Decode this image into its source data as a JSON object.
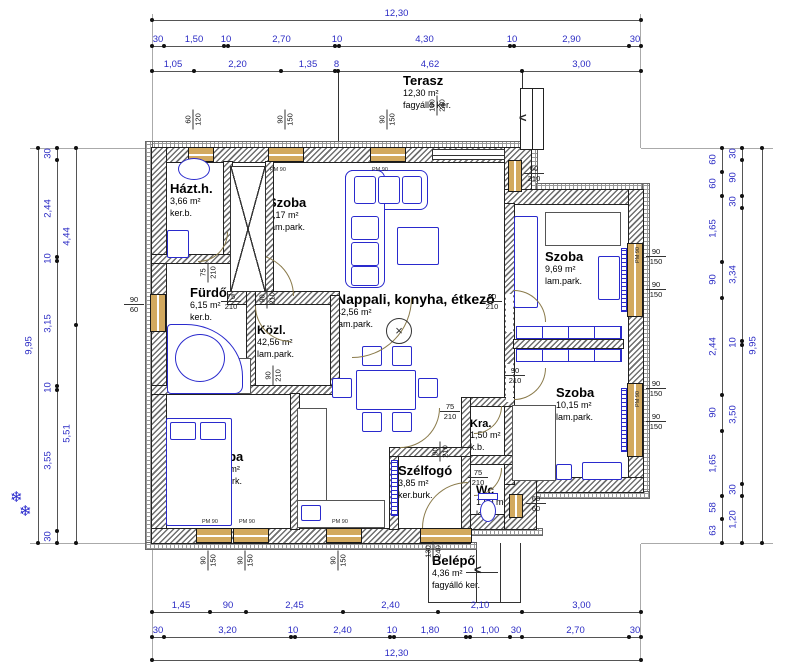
{
  "colors": {
    "dim_text": "#2b2bc4",
    "ink": "#1a1a1a",
    "furniture": "#2a2acd",
    "window_wood": "#d2a95f",
    "door_arc": "#8a7a4a"
  },
  "icons": {
    "stair_arrow": "<",
    "entry_arrow": "<",
    "snowflake": "❄",
    "lamp_cross": "×"
  },
  "rooms": [
    {
      "name": "Terasz",
      "area": "12,30 m²",
      "finish": "fagyálló ker."
    },
    {
      "name": "Házt.h.",
      "area": "3,66 m²",
      "finish": "ker.b."
    },
    {
      "name": "Szoba",
      "area": "8,17 m²",
      "finish": "lam.park."
    },
    {
      "name": "Fürdő",
      "area": "6,15 m²",
      "finish": "ker.b."
    },
    {
      "name": "Közl.",
      "area": "42,56 m²",
      "finish": "lam.park."
    },
    {
      "name": "Nappali, konyha, étkező",
      "area": "42,56 m²",
      "finish": "lam.park."
    },
    {
      "name": "Szoba",
      "area": "11,37 m²",
      "finish": "lam.park."
    },
    {
      "name": "Szoba",
      "area": "9,69 m²",
      "finish": "lam.park."
    },
    {
      "name": "Szoba",
      "area": "10,15 m²",
      "finish": "lam.park."
    },
    {
      "name": "Kra.",
      "area": "1,50 m²",
      "finish": "k.b."
    },
    {
      "name": "Szélfogó",
      "area": "3,85 m²",
      "finish": "ker.burk."
    },
    {
      "name": "Wc",
      "area": "1,60 m²",
      "finish": "k.b."
    },
    {
      "name": "Belépő",
      "area": "4,36 m²",
      "finish": "fagyálló ker."
    }
  ],
  "dim_lines": [
    {
      "o": "h",
      "pos": 20,
      "ticks": [
        152,
        641
      ],
      "labels": [
        "12,30"
      ]
    },
    {
      "o": "h",
      "pos": 46,
      "ticks": [
        152,
        164,
        224,
        228,
        335,
        339,
        510,
        514,
        629,
        641
      ],
      "labels": [
        "30",
        "1,50",
        "10",
        "2,70",
        "10",
        "4,30",
        "10",
        "2,90",
        "30"
      ]
    },
    {
      "o": "h",
      "pos": 71,
      "ticks": [
        152,
        194,
        281,
        335,
        338,
        522,
        641
      ],
      "labels": [
        "1,05",
        "2,20",
        "1,35",
        "8",
        "4,62",
        "3,00"
      ]
    },
    {
      "o": "h",
      "pos": 612,
      "ticks": [
        152,
        210,
        246,
        343,
        438,
        522,
        641
      ],
      "labels": [
        "1,45",
        "90",
        "2,45",
        "2,40",
        "2,10",
        "3,00"
      ]
    },
    {
      "o": "h",
      "pos": 637,
      "ticks": [
        152,
        164,
        291,
        295,
        390,
        394,
        466,
        470,
        510,
        522,
        629,
        641
      ],
      "labels": [
        "30",
        "3,20",
        "10",
        "2,40",
        "10",
        "1,80",
        "10",
        "1,00",
        "30",
        "2,70",
        "30"
      ]
    },
    {
      "o": "h",
      "pos": 660,
      "ticks": [
        152,
        641
      ],
      "labels": [
        "12,30"
      ]
    },
    {
      "o": "v",
      "pos": 38,
      "ticks": [
        148,
        543
      ],
      "labels": [
        "9,95"
      ]
    },
    {
      "o": "v",
      "pos": 57,
      "ticks": [
        148,
        160,
        257,
        261,
        386,
        390,
        531,
        543
      ],
      "labels": [
        "30",
        "2,44",
        "10",
        "3,15",
        "10",
        "3,55",
        "30"
      ]
    },
    {
      "o": "v",
      "pos": 76,
      "ticks": [
        148,
        325,
        543
      ],
      "labels": [
        "4,44",
        "5,51"
      ]
    },
    {
      "o": "v",
      "pos": 722,
      "ticks": [
        148,
        172,
        196,
        262,
        298,
        395,
        431,
        496,
        519,
        543
      ],
      "labels": [
        "60",
        "60",
        "1,65",
        "90",
        "2,44",
        "90",
        "1,65",
        "58",
        "63"
      ]
    },
    {
      "o": "v",
      "pos": 742,
      "ticks": [
        148,
        160,
        196,
        208,
        341,
        345,
        484,
        496,
        543
      ],
      "labels": [
        "30",
        "90",
        "30",
        "3,34",
        "10",
        "3,50",
        "30",
        "1,20"
      ]
    },
    {
      "o": "v",
      "pos": 762,
      "ticks": [
        148,
        543
      ],
      "labels": [
        "9,95"
      ]
    }
  ],
  "frac_labels": [
    [
      "60",
      "120",
      183,
      110,
      1
    ],
    [
      "90",
      "150",
      275,
      110,
      1
    ],
    [
      "90",
      "150",
      377,
      110,
      1
    ],
    [
      "180",
      "240",
      427,
      96,
      1
    ],
    [
      "60",
      "210",
      524,
      164,
      0
    ],
    [
      "90",
      "150",
      646,
      247,
      0
    ],
    [
      "90",
      "150",
      646,
      280,
      0
    ],
    [
      "90",
      "150",
      646,
      379,
      0
    ],
    [
      "90",
      "150",
      646,
      412,
      0
    ],
    [
      "90",
      "60",
      124,
      295,
      0
    ],
    [
      "60",
      "60",
      526,
      494,
      0
    ],
    [
      "90",
      "150",
      198,
      551,
      1
    ],
    [
      "90",
      "150",
      235,
      551,
      1
    ],
    [
      "90",
      "150",
      328,
      551,
      1
    ],
    [
      "130",
      "240",
      423,
      542,
      1
    ],
    [
      "75",
      "210",
      198,
      263,
      1
    ],
    [
      "75",
      "210",
      221,
      292,
      0
    ],
    [
      "90",
      "210",
      257,
      289,
      1
    ],
    [
      "90",
      "210",
      263,
      366,
      1
    ],
    [
      "90",
      "210",
      482,
      292,
      0
    ],
    [
      "90",
      "210",
      505,
      366,
      0
    ],
    [
      "75",
      "210",
      440,
      402,
      0
    ],
    [
      "75",
      "210",
      468,
      468,
      0
    ],
    [
      "90",
      "210",
      430,
      442,
      1
    ]
  ],
  "pm_labels": [
    [
      "PM 120",
      186,
      167,
      0
    ],
    [
      "PM 90",
      270,
      167,
      0
    ],
    [
      "PM 90",
      372,
      167,
      0
    ],
    [
      "PM 90",
      202,
      519,
      0
    ],
    [
      "PM 90",
      239,
      519,
      0
    ],
    [
      "PM 90",
      332,
      519,
      0
    ],
    [
      "PM 90",
      630,
      252,
      1
    ],
    [
      "PM 90",
      630,
      396,
      1
    ]
  ],
  "walls": [
    [
      146,
      142,
      391,
      6,
      "i"
    ],
    [
      146,
      142,
      6,
      407,
      "i"
    ],
    [
      146,
      543,
      330,
      6,
      "i"
    ],
    [
      466,
      529,
      76,
      6,
      "i"
    ],
    [
      531,
      142,
      6,
      48,
      "i"
    ],
    [
      537,
      184,
      112,
      6,
      "i"
    ],
    [
      643,
      184,
      6,
      314,
      "i"
    ],
    [
      536,
      492,
      113,
      6,
      "i"
    ],
    [
      152,
      148,
      379,
      14,
      "w"
    ],
    [
      152,
      148,
      14,
      395,
      "w"
    ],
    [
      152,
      529,
      318,
      14,
      "w"
    ],
    [
      466,
      515,
      70,
      14,
      "w"
    ],
    [
      505,
      148,
      26,
      56,
      "w"
    ],
    [
      505,
      190,
      138,
      14,
      "w"
    ],
    [
      629,
      190,
      14,
      302,
      "w"
    ],
    [
      536,
      478,
      107,
      14,
      "w"
    ],
    [
      505,
      440,
      31,
      89,
      "w"
    ],
    [
      224,
      162,
      8,
      101,
      "w"
    ],
    [
      266,
      162,
      7,
      134,
      "w"
    ],
    [
      152,
      255,
      80,
      8,
      "w"
    ],
    [
      228,
      292,
      111,
      12,
      "w"
    ],
    [
      247,
      263,
      8,
      129,
      "w"
    ],
    [
      331,
      296,
      8,
      94,
      "w"
    ],
    [
      152,
      386,
      187,
      8,
      "w"
    ],
    [
      291,
      394,
      8,
      135,
      "w"
    ],
    [
      505,
      204,
      9,
      280,
      "w"
    ],
    [
      514,
      340,
      109,
      8,
      "w"
    ],
    [
      462,
      398,
      52,
      8,
      "w"
    ],
    [
      462,
      398,
      8,
      66,
      "w"
    ],
    [
      462,
      456,
      52,
      8,
      "w"
    ],
    [
      462,
      456,
      8,
      73,
      "w"
    ],
    [
      390,
      448,
      8,
      81,
      "w"
    ],
    [
      390,
      448,
      80,
      8,
      "w"
    ]
  ],
  "gaps": [
    [
      506,
      294,
      7,
      38
    ],
    [
      506,
      364,
      7,
      38
    ]
  ],
  "windows": [
    [
      188,
      147,
      26,
      15,
      "h"
    ],
    [
      268,
      147,
      36,
      15,
      "h"
    ],
    [
      370,
      147,
      36,
      15,
      "h"
    ],
    [
      508,
      160,
      14,
      32,
      "v"
    ],
    [
      627,
      243,
      16,
      74,
      "v"
    ],
    [
      627,
      383,
      16,
      74,
      "v"
    ],
    [
      150,
      294,
      16,
      38,
      "v"
    ],
    [
      196,
      528,
      36,
      15,
      "h"
    ],
    [
      233,
      528,
      36,
      15,
      "h"
    ],
    [
      326,
      528,
      36,
      15,
      "h"
    ],
    [
      420,
      528,
      52,
      15,
      "h"
    ],
    [
      509,
      494,
      14,
      24,
      "v"
    ]
  ],
  "glass_doors": [
    [
      432,
      149,
      73,
      11
    ]
  ],
  "furniture": [
    [
      345,
      170,
      83,
      40,
      "b",
      8
    ],
    [
      345,
      170,
      40,
      118,
      "b",
      8
    ],
    [
      354,
      176,
      22,
      28,
      "b",
      3
    ],
    [
      378,
      176,
      22,
      28,
      "b",
      3
    ],
    [
      402,
      176,
      20,
      28,
      "b",
      3
    ],
    [
      351,
      216,
      28,
      24,
      "b",
      3
    ],
    [
      351,
      242,
      28,
      24,
      "b",
      3
    ],
    [
      351,
      266,
      28,
      20,
      "b",
      3
    ],
    [
      397,
      227,
      42,
      38,
      "b",
      2
    ],
    [
      356,
      370,
      60,
      40,
      "b",
      2
    ],
    [
      362,
      346,
      20,
      20,
      "b",
      2
    ],
    [
      392,
      346,
      20,
      20,
      "b",
      2
    ],
    [
      362,
      412,
      20,
      20,
      "b",
      2
    ],
    [
      392,
      412,
      20,
      20,
      "b",
      2
    ],
    [
      332,
      378,
      20,
      20,
      "b",
      2
    ],
    [
      418,
      378,
      20,
      20,
      "b",
      2
    ],
    [
      297,
      408,
      30,
      120,
      "g",
      0
    ],
    [
      297,
      500,
      88,
      28,
      "g",
      0
    ],
    [
      301,
      505,
      20,
      16,
      "b",
      2
    ],
    [
      166,
      418,
      66,
      108,
      "b",
      2
    ],
    [
      170,
      422,
      26,
      18,
      "b",
      2
    ],
    [
      200,
      422,
      26,
      18,
      "b",
      2
    ],
    [
      514,
      216,
      24,
      92,
      "b",
      2
    ],
    [
      545,
      212,
      76,
      34,
      "g",
      0
    ],
    [
      598,
      256,
      22,
      44,
      "b",
      2
    ],
    [
      621,
      248,
      6,
      64,
      "rad",
      0
    ],
    [
      621,
      388,
      6,
      64,
      "rad",
      0
    ],
    [
      391,
      460,
      7,
      56,
      "rad",
      0
    ],
    [
      516,
      326,
      106,
      13,
      "wr",
      0
    ],
    [
      516,
      349,
      106,
      13,
      "wr",
      0
    ],
    [
      512,
      405,
      44,
      76,
      "g",
      0
    ],
    [
      582,
      462,
      40,
      18,
      "b",
      2
    ],
    [
      556,
      464,
      16,
      16,
      "b",
      2
    ],
    [
      167,
      230,
      22,
      28,
      "b",
      2
    ],
    [
      225,
      358,
      26,
      36,
      "g",
      0
    ]
  ],
  "arcs": [
    [
      198,
      232,
      30,
      "br"
    ],
    [
      252,
      254,
      42,
      "tr"
    ],
    [
      255,
      306,
      36,
      "bl"
    ],
    [
      352,
      298,
      60,
      "br"
    ],
    [
      514,
      290,
      32,
      "tr"
    ],
    [
      514,
      368,
      32,
      "br"
    ],
    [
      474,
      406,
      28,
      "br"
    ],
    [
      474,
      468,
      28,
      "br"
    ],
    [
      422,
      482,
      46,
      "tl"
    ],
    [
      400,
      408,
      40,
      "br"
    ]
  ],
  "lines": [
    [
      152,
      14,
      1,
      134,
      "#aaa"
    ],
    [
      640,
      14,
      1,
      134,
      "#aaa"
    ],
    [
      152,
      544,
      1,
      118,
      "#aaa"
    ],
    [
      640,
      544,
      1,
      118,
      "#aaa"
    ],
    [
      30,
      148,
      122,
      1,
      "#aaa"
    ],
    [
      30,
      543,
      122,
      1,
      "#aaa"
    ],
    [
      641,
      148,
      132,
      1,
      "#aaa"
    ],
    [
      641,
      543,
      132,
      1,
      "#aaa"
    ],
    [
      338,
      72,
      1,
      77,
      "#333"
    ],
    [
      522,
      72,
      1,
      117,
      "#333"
    ],
    [
      428,
      543,
      1,
      60,
      "#333"
    ],
    [
      520,
      543,
      1,
      60,
      "#333"
    ],
    [
      428,
      602,
      93,
      1,
      "#333"
    ],
    [
      476,
      543,
      1,
      60,
      "#333"
    ],
    [
      500,
      543,
      1,
      60,
      "#333"
    ],
    [
      466,
      572,
      32,
      1,
      "#333"
    ]
  ],
  "specials": {
    "lamp": [
      386,
      318,
      26
    ],
    "xbox": [
      230,
      166,
      36,
      126
    ],
    "tub": [
      167,
      324,
      76,
      70
    ],
    "sink": [
      178,
      158,
      32,
      22
    ],
    "toilet": [
      480,
      500,
      16,
      22,
      478,
      493,
      20,
      7
    ],
    "stairs": [
      520,
      88,
      24,
      62
    ],
    "stair_arrow": [
      519,
      110
    ],
    "entry_arrow": [
      474,
      562
    ],
    "snowflakes": [
      [
        10,
        488
      ],
      [
        19,
        502
      ]
    ]
  }
}
